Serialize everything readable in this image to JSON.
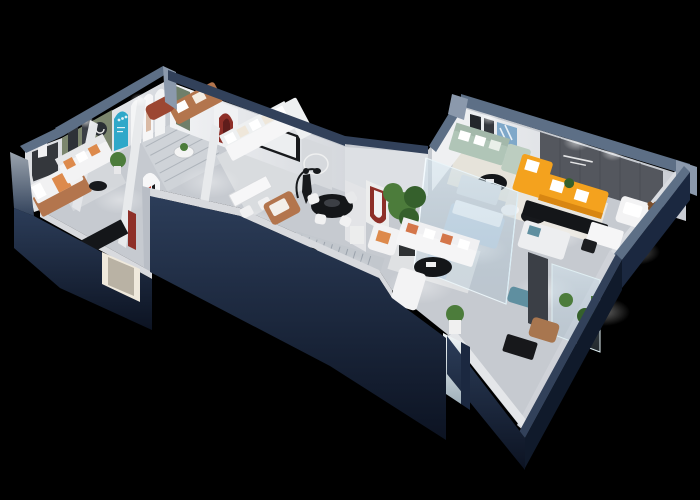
{
  "scene": {
    "type": "3d-isometric-floorplan-render",
    "subject": "furniture showroom dollhouse cutaway, two angled wings on black background",
    "background": "#000000"
  },
  "colors": {
    "background": "#000000",
    "wall_navy": "#1b2840",
    "wall_navy_dark": "#101a2b",
    "wall_navy_light": "#2c3d59",
    "wall_top": "#5d6f86",
    "wall_top_light": "#8b99ac",
    "wall_top_dark": "#32415a",
    "floor": "#c6cad0",
    "rug_light": "#e6e3da",
    "rug_gray": "#d9dcdf",
    "wall_white": "#e9eaec",
    "wall_shadow": "#d2d4d9",
    "accent_olive": "#7c866e",
    "accent_cyan": "#2fa8c9",
    "accent_red": "#8e2f28",
    "accent_red_dark": "#5f1d1b",
    "door_green": "#6f7f6a",
    "panel_gray": "#54575e",
    "sofa_orange": "#f4a21e",
    "sofa_orange_dark": "#d88612",
    "sofa_white": "#f3f3f4",
    "sofa_sage": "#b0c5b7",
    "pillow_orange": "#dd8a4c",
    "leather": "#b3754d",
    "leather_red": "#9c4732",
    "plant_green": "#4c7c3b",
    "plant_dark": "#35602c",
    "furniture_black": "#141619",
    "pale_blue": "#c3d3e2",
    "teal": "#5f8fa0",
    "bear_brown": "#7c4f2c",
    "mirror": "#cdd6da"
  }
}
